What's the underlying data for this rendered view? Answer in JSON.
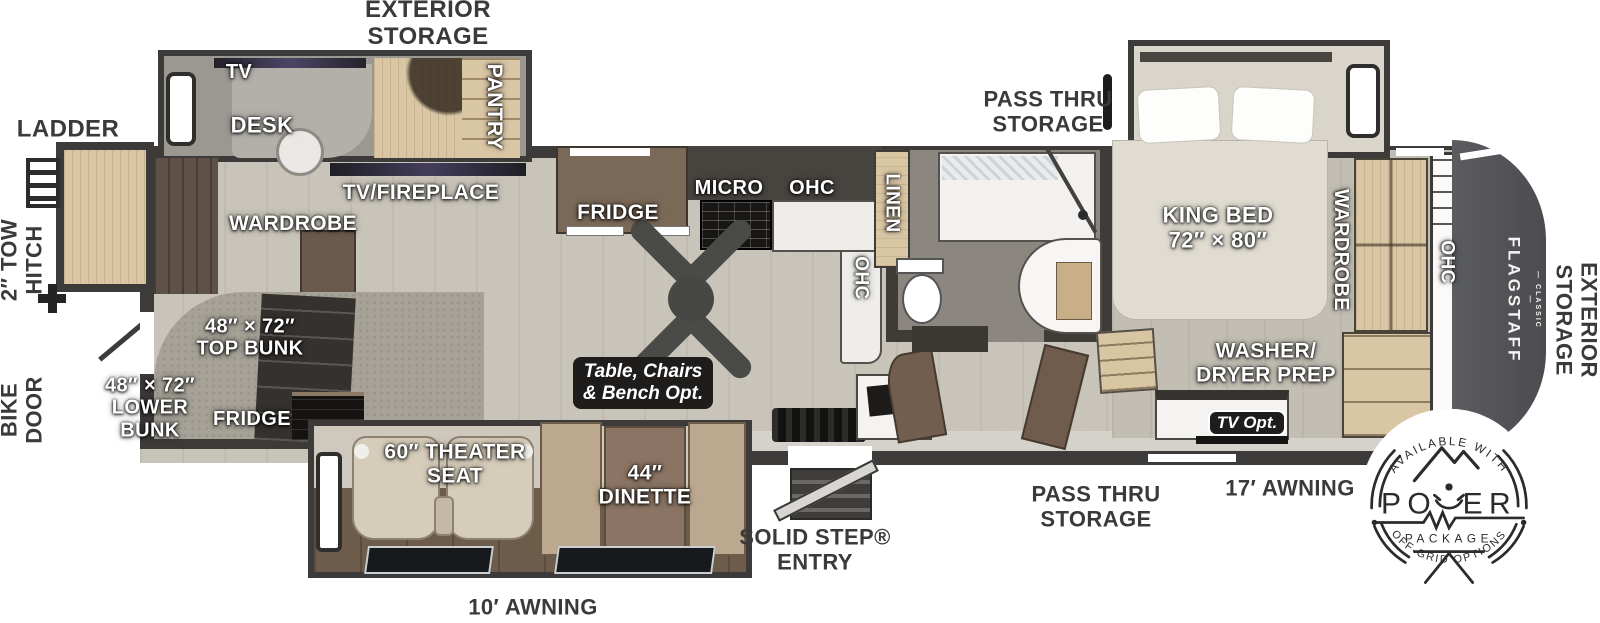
{
  "labels": {
    "ext": {
      "storage_top": "EXTERIOR\nSTORAGE",
      "ladder": "LADDER",
      "tow_hitch": "2″ TOW\nHITCH",
      "bike_door": "BIKE\nDOOR",
      "pass_thru_top": "PASS THRU\nSTORAGE",
      "pass_thru_bottom": "PASS THRU\nSTORAGE",
      "solid_step": "SOLID STEP®\nENTRY",
      "awning_10": "10′ AWNING",
      "awning_17": "17′ AWNING",
      "storage_right": "EXTERIOR\nSTORAGE"
    },
    "int": {
      "tv": "TV",
      "desk": "DESK",
      "pantry": "PANTRY",
      "tv_fireplace": "TV/FIREPLACE",
      "wardrobe_rear": "WARDROBE",
      "fridge_kitchen": "FRIDGE",
      "micro": "MICRO",
      "ohc_kitchen": "OHC",
      "ohc_island": "OHC",
      "linen": "LINEN",
      "king_bed": "KING BED\n72″ × 80″",
      "wardrobe_front": "WARDROBE",
      "ohc_front": "OHC",
      "top_bunk": "48″ × 72″\nTOP BUNK",
      "lower_bunk": "48″ × 72″\nLOWER\nBUNK",
      "fridge_bunk": "FRIDGE",
      "theater_seat": "60″ THEATER\nSEAT",
      "dinette": "44″\nDINETTE",
      "washer_dryer": "WASHER/\nDRYER PREP"
    },
    "options": {
      "table_chairs": "Table, Chairs\n& Bench Opt.",
      "tv_opt": "TV Opt."
    },
    "brand": {
      "flagstaff": "FLAGSTAFF",
      "classic": "— CLASSIC —"
    },
    "badge": {
      "available": "AVAILABLE WITH",
      "power_left": "PO",
      "power_right": "ER",
      "package": "PACKAGE",
      "off_grid": "OFF-GRID OPTIONS"
    }
  },
  "colors": {
    "wall": "#3c3b39",
    "floor": "#c8c4ba",
    "carpet": "#a6a298",
    "wood_light": "#d9c6a4",
    "cabinet_brown": "#7b6958",
    "front_cap": "#55565a",
    "seat_beige": "#d6ccba",
    "slide_floor": "#6e5c4b",
    "label_light": "#ffffff",
    "label_dark": "#3a3a3a",
    "option_box": "#1e1d1b"
  }
}
